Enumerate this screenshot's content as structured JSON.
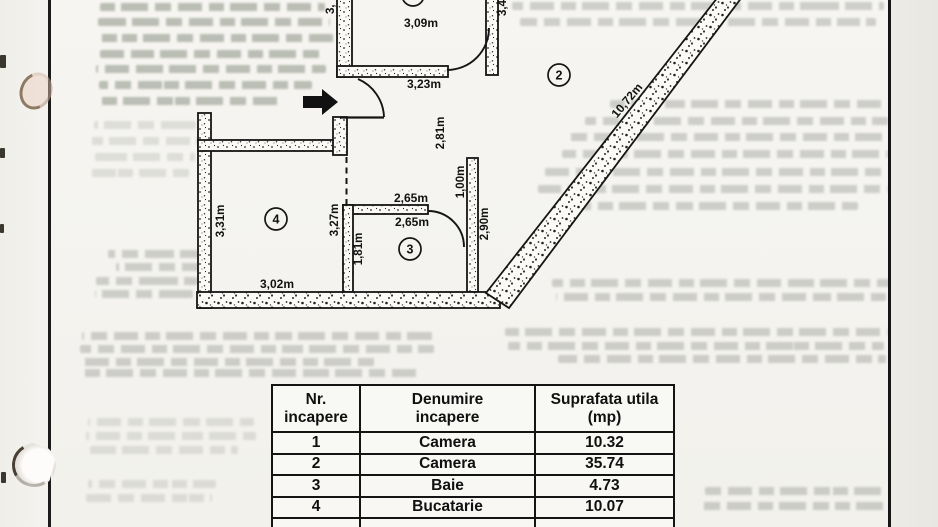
{
  "floor_plan": {
    "rooms": {
      "r2": "2",
      "r3": "3",
      "r4": "4"
    },
    "labels": {
      "r1_width": "3,09m",
      "r1_bottom": "3,23m",
      "r1_left_partial": "3,",
      "r1_right_partial": "3,4",
      "hall_height": "2,81m",
      "diagonal": "10,72m",
      "r3_top_a": "2,65m",
      "r3_top_b": "2,65m",
      "r3_left": "1,81m",
      "r3_right_upper": "1,00m",
      "r3_right": "2,90m",
      "r4_left": "3,31m",
      "r4_right": "3,27m",
      "r4_bottom": "3,02m"
    }
  },
  "table": {
    "headers": [
      {
        "line1": "Nr.",
        "line2": "incapere"
      },
      {
        "line1": "Denumire",
        "line2": "incapere"
      },
      {
        "line1": "Suprafata utila",
        "line2": "(mp)"
      }
    ],
    "rows": [
      {
        "nr": "1",
        "room": "Camera",
        "area": "10.32"
      },
      {
        "nr": "2",
        "room": "Camera",
        "area": "35.74"
      },
      {
        "nr": "3",
        "room": "Baie",
        "area": "4.73"
      },
      {
        "nr": "4",
        "room": "Bucatarie",
        "area": "10.07"
      }
    ]
  }
}
